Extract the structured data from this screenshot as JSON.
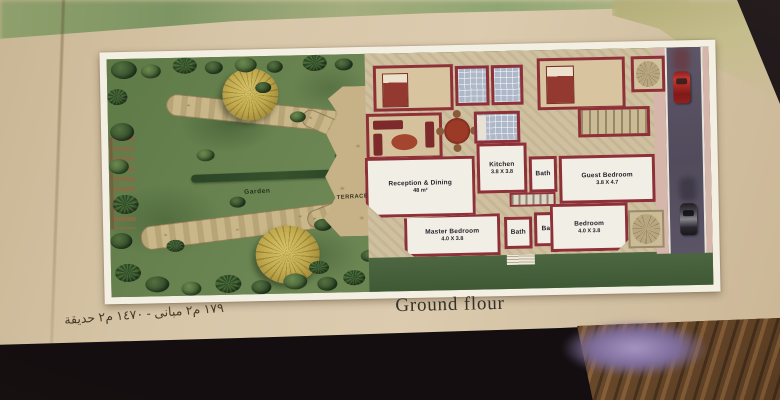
{
  "photo": {
    "caption": "Ground flour",
    "area_note_ar": "١٧٩ م٢ مبانى - ١٤٧٠ م٢ حديقة"
  },
  "plan": {
    "garden_label": "Garden",
    "terrace_label": "TERRACE",
    "rooms": {
      "reception": {
        "name": "Reception & Dining",
        "dims": "48 m²"
      },
      "kitchen": {
        "name": "Kitchen",
        "dims": "3.8 X 3.8"
      },
      "bath_hall": {
        "name": "Bath"
      },
      "guest": {
        "name": "Guest Bedroom",
        "dims": "3.8 X 4.7"
      },
      "master": {
        "name": "Master Bedroom",
        "dims": "4.0 X 3.8"
      },
      "bath_master": {
        "name": "Bath"
      },
      "bath_2": {
        "name": "Bath"
      },
      "bedroom": {
        "name": "Bedroom",
        "dims": "4.0 X 3.8"
      }
    },
    "colors": {
      "wall": "#8e3038",
      "garden": "#66804d",
      "page": "#d7c6a8",
      "road": "#585264",
      "tree": "#c2ab4e",
      "car_red": "#b03028"
    }
  }
}
